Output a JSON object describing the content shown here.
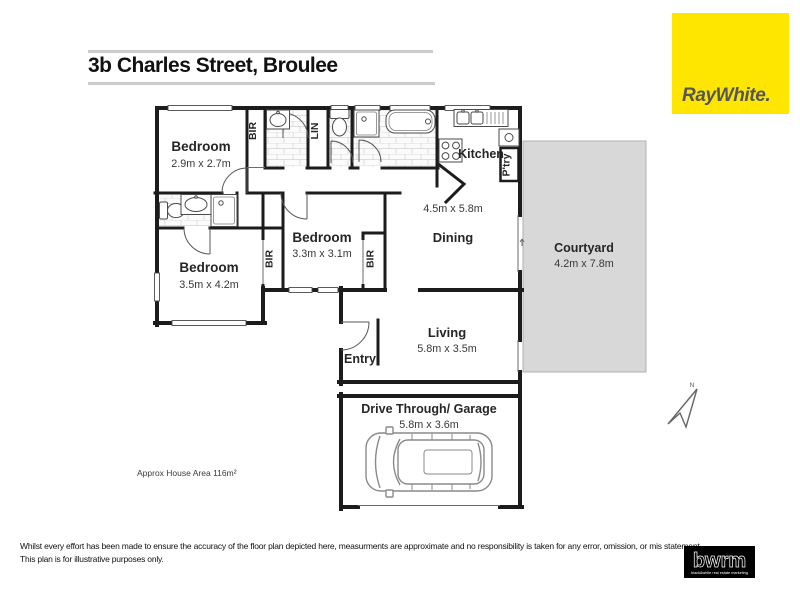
{
  "title": "3b Charles Street, Broulee",
  "branding": {
    "raywhite_logo_text": "RayWhite.",
    "bwrm_logo_text": "bwrm",
    "bwrm_tagline": "black&white real estate marketing"
  },
  "plan": {
    "area_note": "Approx House Area 116m²",
    "north_label": "N",
    "rooms": {
      "bedroom1": {
        "name": "Bedroom",
        "dims": "2.9m x 2.7m"
      },
      "bedroom2": {
        "name": "Bedroom",
        "dims": "3.5m x 4.2m"
      },
      "bedroom3": {
        "name": "Bedroom",
        "dims": "3.3m x 3.1m"
      },
      "dining": {
        "name": "Dining",
        "dims": "4.5m x 5.8m"
      },
      "kitchen": {
        "name": "Kitchen"
      },
      "pantry": {
        "name": "P'try"
      },
      "courtyard": {
        "name": "Courtyard",
        "dims": "4.2m x 7.8m"
      },
      "living": {
        "name": "Living",
        "dims": "5.8m x 3.5m"
      },
      "entry": {
        "name": "Entry"
      },
      "garage": {
        "name": "Drive Through/ Garage",
        "dims": "5.8m x 3.6m"
      },
      "bir": "BIR",
      "lin": "LIN"
    }
  },
  "footer": {
    "line1": "Whilst every effort has been made to ensure the accuracy of the floor plan depicted here, measurments are approximate and no responsibility is taken for any error, omission, or mis statement.",
    "line2": "This plan is for illustrative purposes only.",
    "raywhite_alt": "RayWhite."
  },
  "colors": {
    "brand_yellow": "#FFE600",
    "wall": "#1c1c1c",
    "courtyard_fill": "#d8d8d8"
  }
}
